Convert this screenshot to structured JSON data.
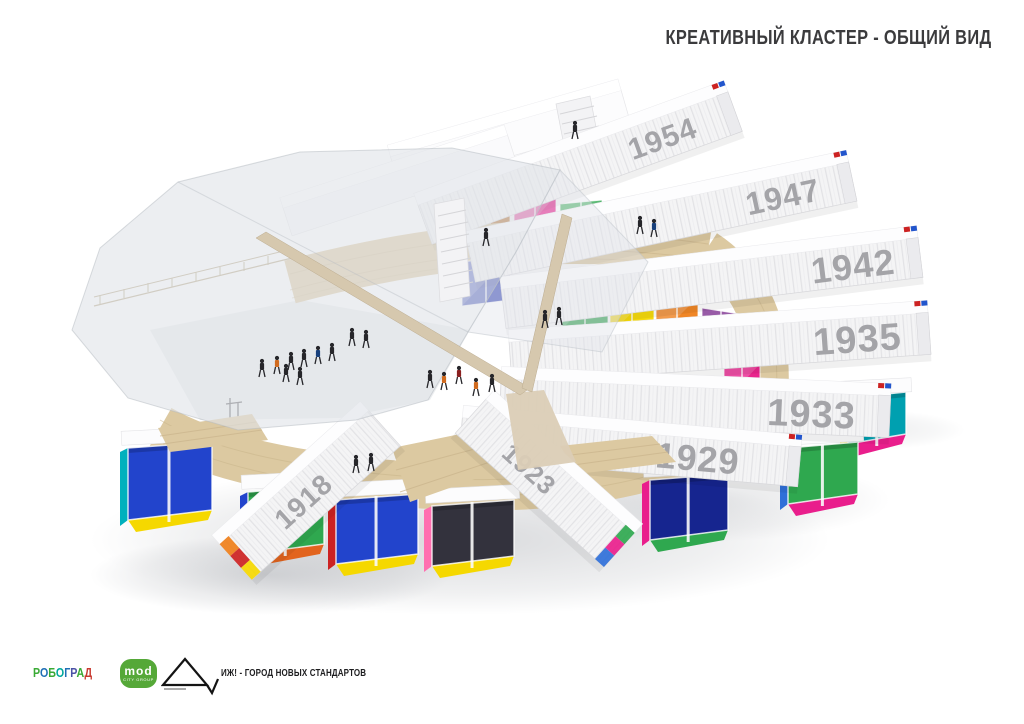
{
  "title": "КРЕАТИВНЫЙ КЛАСТЕР - ОБЩИЙ ВИД",
  "scene": {
    "description": "3d-render-of-spiral-container-cluster",
    "containers": [
      {
        "year": "1954",
        "cx": 580,
        "cy": 168,
        "len": 330,
        "h": 42,
        "angle": -20,
        "fs": 30,
        "year_dx": -42,
        "cap": "right",
        "layer": "back"
      },
      {
        "year": "1947",
        "cx": 662,
        "cy": 222,
        "len": 390,
        "h": 40,
        "angle": -12,
        "fs": 32,
        "year_dx": -34,
        "cap": "right",
        "layer": "back"
      },
      {
        "year": "1942",
        "cx": 712,
        "cy": 283,
        "len": 420,
        "h": 40,
        "angle": -7,
        "fs": 36,
        "year_dx": -26,
        "cap": "right",
        "layer": "back"
      },
      {
        "year": "1935",
        "cx": 720,
        "cy": 348,
        "len": 420,
        "h": 42,
        "angle": -4,
        "fs": 38,
        "year_dx": -28,
        "cap": "right",
        "layer": "back"
      },
      {
        "year": "1933",
        "cx": 695,
        "cy": 408,
        "len": 390,
        "h": 42,
        "angle": 2.5,
        "fs": 38,
        "year_dx": -34,
        "cap": "right",
        "layer": "back"
      },
      {
        "year": "1929",
        "cx": 630,
        "cy": 452,
        "len": 340,
        "h": 40,
        "angle": 5,
        "fs": 36,
        "year_dx": -60,
        "cap": "right",
        "layer": "back"
      },
      {
        "year": "1923",
        "cx": 545,
        "cy": 483,
        "len": 200,
        "h": 46,
        "angle": 42,
        "fs": 26,
        "year_dx": -90,
        "cap": "right",
        "cap_colors": [
          "#2fa84f",
          "#e91e8c",
          "#2f6fd8"
        ],
        "layer": "front"
      },
      {
        "year": "1918",
        "cx": 310,
        "cy": 495,
        "len": 200,
        "h": 48,
        "angle": -42,
        "fs": 28,
        "year_dx": -76,
        "cap": "left",
        "cap_colors": [
          "#ef7f1a",
          "#cc2222",
          "#f5d800"
        ],
        "layer": "front"
      }
    ],
    "glass_panels": [
      {
        "x": 470,
        "y": 198,
        "w": 40,
        "h": 42,
        "dy": -5,
        "color": "#b5651d"
      },
      {
        "x": 514,
        "y": 200,
        "w": 42,
        "h": 43,
        "dy": -5,
        "color": "#e91e8c"
      },
      {
        "x": 560,
        "y": 204,
        "w": 42,
        "h": 43,
        "dy": -4,
        "color": "#2fa84f"
      },
      {
        "x": 606,
        "y": 210,
        "w": 40,
        "h": 42,
        "dy": -3,
        "color": "#00b0bd"
      },
      {
        "x": 650,
        "y": 216,
        "w": 38,
        "h": 41,
        "dy": -2,
        "color": "#ef7f1a"
      },
      {
        "x": 462,
        "y": 262,
        "w": 48,
        "h": 44,
        "dy": -6,
        "color": "#4150b8"
      },
      {
        "x": 514,
        "y": 280,
        "w": 46,
        "h": 43,
        "dy": -5,
        "color": "#e91e8c"
      },
      {
        "x": 562,
        "y": 286,
        "w": 46,
        "h": 43,
        "dy": -3,
        "color": "#2fa84f"
      },
      {
        "x": 610,
        "y": 291,
        "w": 44,
        "h": 44,
        "dy": -1,
        "color": "#f5d800"
      },
      {
        "x": 656,
        "y": 295,
        "w": 42,
        "h": 44,
        "dy": 2,
        "color": "#ef7f1a"
      },
      {
        "x": 702,
        "y": 308,
        "w": 38,
        "h": 46,
        "dy": 6,
        "color": "#7b2d8e"
      },
      {
        "x": 724,
        "y": 356,
        "w": 36,
        "h": 46,
        "dy": 8,
        "color": "#e91e8c"
      }
    ],
    "interiors": [
      {
        "x": 848,
        "y": 398,
        "w": 58,
        "h": 46,
        "colors": [
          "#00a0b0",
          "#e91e8c",
          "#f5d800"
        ],
        "layer": "right"
      },
      {
        "x": 788,
        "y": 448,
        "w": 70,
        "h": 56,
        "colors": [
          "#2fa84f",
          "#e91e8c",
          "#2f6fd8"
        ],
        "layer": "right"
      },
      {
        "x": 650,
        "y": 480,
        "w": 78,
        "h": 60,
        "colors": [
          "#16258f",
          "#2fa84f",
          "#e91e8c"
        ],
        "layer": "right"
      },
      {
        "x": 128,
        "y": 448,
        "w": 84,
        "h": 72,
        "colors": [
          "#2244cc",
          "#f5d800",
          "#00b0bd"
        ],
        "layer": "left"
      },
      {
        "x": 248,
        "y": 492,
        "w": 76,
        "h": 62,
        "colors": [
          "#2fa84f",
          "#e2641e",
          "#2244cc"
        ],
        "layer": "left"
      },
      {
        "x": 336,
        "y": 500,
        "w": 82,
        "h": 64,
        "colors": [
          "#2244cc",
          "#f5d800",
          "#cc2222"
        ],
        "layer": "left"
      },
      {
        "x": 432,
        "y": 506,
        "w": 82,
        "h": 60,
        "colors": [
          "#33323d",
          "#f5d800",
          "#ff6fb0"
        ],
        "layer": "left"
      }
    ],
    "people": [
      {
        "x": 262,
        "y": 372,
        "c": "#26262a"
      },
      {
        "x": 277,
        "y": 369,
        "c": "#d06a1e"
      },
      {
        "x": 291,
        "y": 365,
        "c": "#26262a"
      },
      {
        "x": 304,
        "y": 362,
        "c": "#26262a"
      },
      {
        "x": 318,
        "y": 359,
        "c": "#18407c"
      },
      {
        "x": 332,
        "y": 356,
        "c": "#26262a"
      },
      {
        "x": 300,
        "y": 380,
        "c": "#26262a"
      },
      {
        "x": 286,
        "y": 377,
        "c": "#26262a"
      },
      {
        "x": 352,
        "y": 341,
        "c": "#26262a"
      },
      {
        "x": 366,
        "y": 343,
        "c": "#26262a"
      },
      {
        "x": 430,
        "y": 383,
        "c": "#26262a"
      },
      {
        "x": 444,
        "y": 385,
        "c": "#d06a1e"
      },
      {
        "x": 459,
        "y": 379,
        "c": "#8a2020"
      },
      {
        "x": 476,
        "y": 391,
        "c": "#d06a1e"
      },
      {
        "x": 492,
        "y": 387,
        "c": "#26262a"
      },
      {
        "x": 640,
        "y": 229,
        "c": "#26262a"
      },
      {
        "x": 654,
        "y": 232,
        "c": "#18407c"
      },
      {
        "x": 486,
        "y": 241,
        "c": "#26262a"
      },
      {
        "x": 545,
        "y": 323,
        "c": "#26262a"
      },
      {
        "x": 559,
        "y": 320,
        "c": "#26262a"
      },
      {
        "x": 356,
        "y": 468,
        "c": "#26262a"
      },
      {
        "x": 371,
        "y": 466,
        "c": "#26262a"
      },
      {
        "x": 575,
        "y": 134,
        "c": "#26262a"
      }
    ],
    "palette": {
      "wood": "#dcc9a1",
      "wood_line": "#c9b48b",
      "container": "#f4f4f5",
      "container_top": "#fdfdfe",
      "year_text": "#a4a4a8",
      "canopy": "#e0e4e9",
      "mast": "#d6c8ae",
      "shadow": "#82868e"
    }
  },
  "footer": {
    "robograd": {
      "text": "РОБОГРАД",
      "letter_colors": [
        "#3aaa35",
        "#1f6fb5",
        "#3aaa35",
        "#00a89c",
        "#1f6fb5",
        "#4a52a5",
        "#3aaa35",
        "#c8392f"
      ]
    },
    "mod": {
      "text": "mod",
      "subtext": "city group",
      "color": "#55a838"
    },
    "partner": "ИЖ! - ГОРОД НОВЫХ СТАНДАРТОВ"
  }
}
